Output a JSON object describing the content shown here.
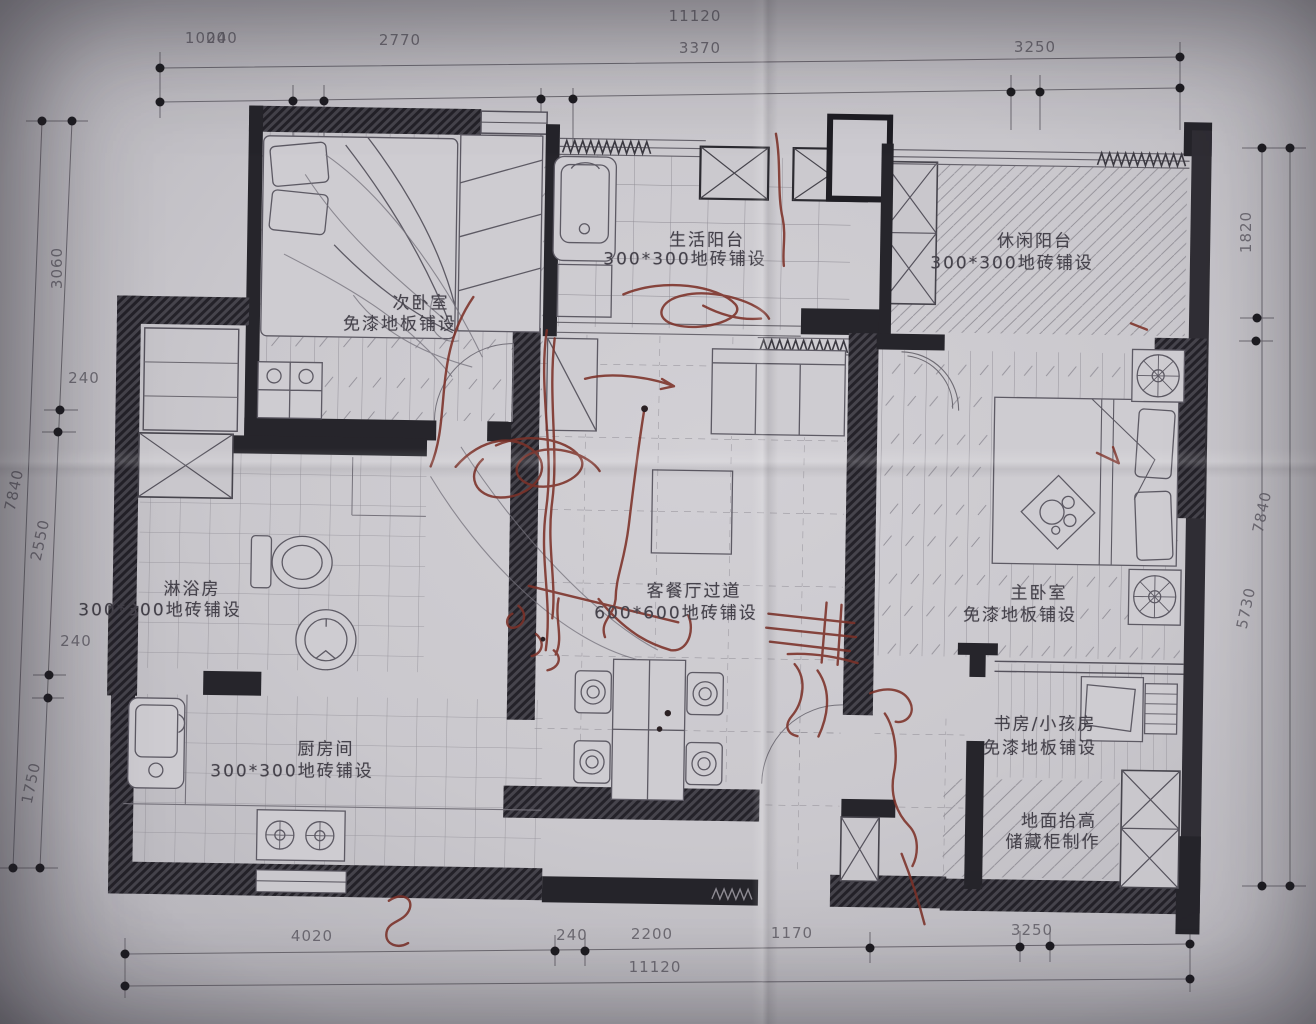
{
  "dimensions": {
    "top": {
      "overall": "11120",
      "seg_a": "1000",
      "seg_a2": "240",
      "seg_b": "2770",
      "seg_c": "3370",
      "seg_d": "3250"
    },
    "bottom": {
      "overall": "11120",
      "seg_a": "4020",
      "seg_b": "240",
      "seg_c": "2200",
      "seg_d": "1170",
      "seg_e": "3250"
    },
    "left": {
      "outer": "7840",
      "seg_a": "3060",
      "seg_b": "240",
      "seg_c": "2550",
      "seg_d": "240",
      "seg_e": "1750"
    },
    "right": {
      "outer": "7840",
      "seg_a": "1820",
      "seg_b": "5730"
    }
  },
  "rooms": {
    "bedroom2": {
      "name": "次卧室",
      "finish": "免漆地板铺设"
    },
    "utility_balcony": {
      "name": "生活阳台",
      "finish": "300*300地砖铺设"
    },
    "leisure_balcony": {
      "name": "休闲阳台",
      "finish": "300*300地砖铺设"
    },
    "shower": {
      "name": "淋浴房",
      "finish": "300*300地砖铺设"
    },
    "living_dining": {
      "name": "客餐厅过道",
      "finish": "600*600地砖铺设"
    },
    "master_bedroom": {
      "name": "主卧室",
      "finish": "免漆地板铺设"
    },
    "kitchen": {
      "name": "厨房间",
      "finish": "300*300地砖铺设"
    },
    "study": {
      "name": "书房/小孩房",
      "finish": "免漆地板铺设"
    },
    "storage": {
      "name": "地面抬高",
      "finish": "储藏柜制作"
    }
  },
  "colors": {
    "paper": "#c9c7cc",
    "ink": "#26252b",
    "pencil": "#75727b",
    "pen_red": "#7c3128"
  }
}
